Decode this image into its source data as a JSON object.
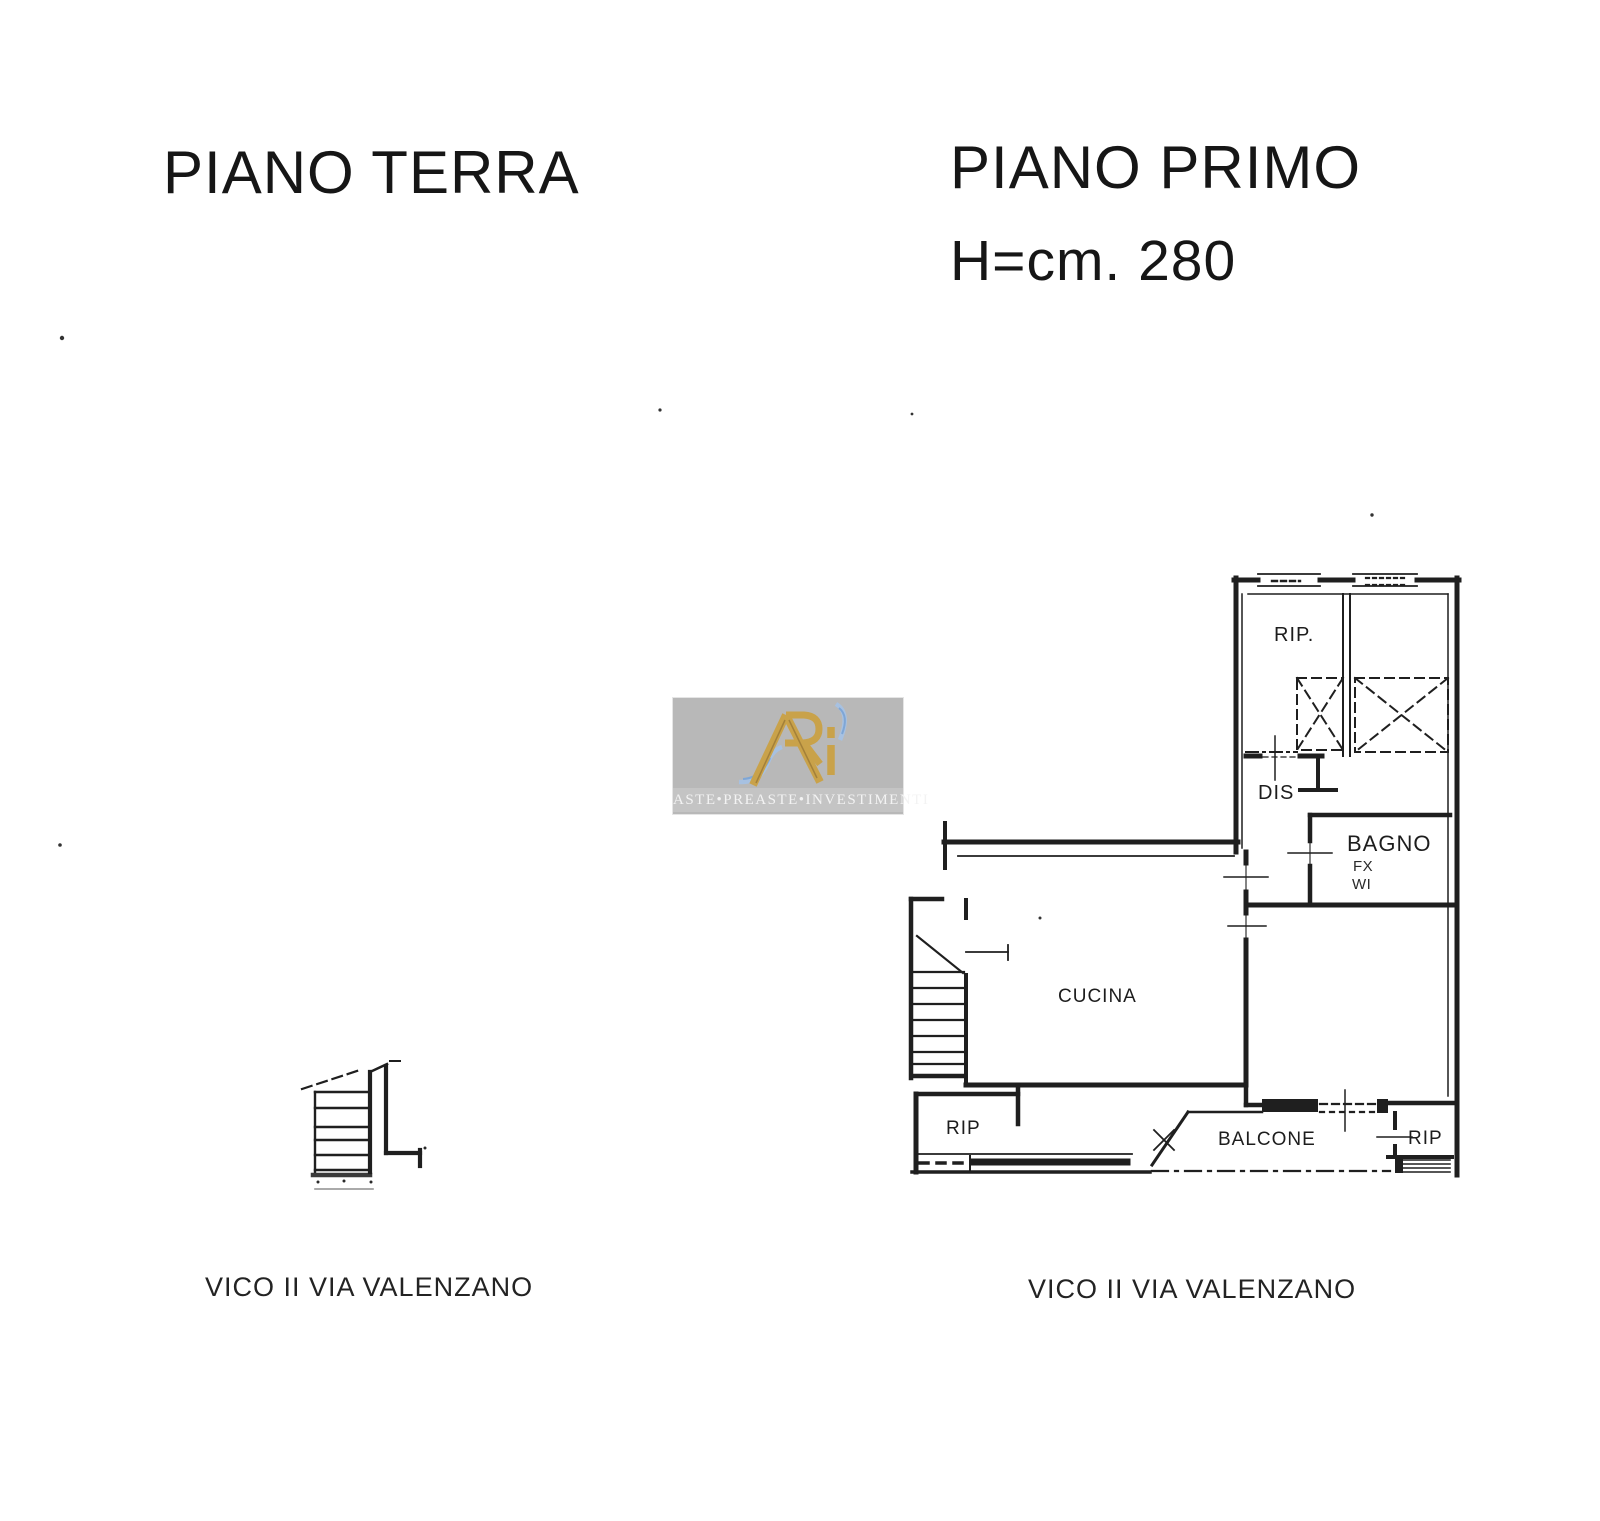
{
  "page": {
    "background": "#ffffff",
    "ink_color": "#1f1f1f",
    "type": "scanned cadastral floor plan, two storeys"
  },
  "ground_floor": {
    "title": "PIANO TERRA",
    "street_label": "VICO II VIA VALENZANO"
  },
  "first_floor": {
    "title": "PIANO PRIMO",
    "height_note": "H=cm. 280",
    "street_label": "VICO II VIA VALENZANO",
    "rooms": {
      "storage_top": "RIP.",
      "hallway": "DIS",
      "bathroom": "BAGNO",
      "bathroom_note_1": "FX",
      "bathroom_note_2": "WI",
      "kitchen": "CUCINA",
      "storage_left": "RIP",
      "balcony": "BALCONE",
      "storage_right": "RIP"
    }
  },
  "watermark": {
    "brand_text": "ASTE•PREASTE•INVESTIMENTI",
    "colors": {
      "panel": "#b8b8b8",
      "band": "#c4c4c4",
      "gold": "#c9a24a",
      "blue": "#a5c2e6",
      "text": "#f3f3f3"
    }
  }
}
